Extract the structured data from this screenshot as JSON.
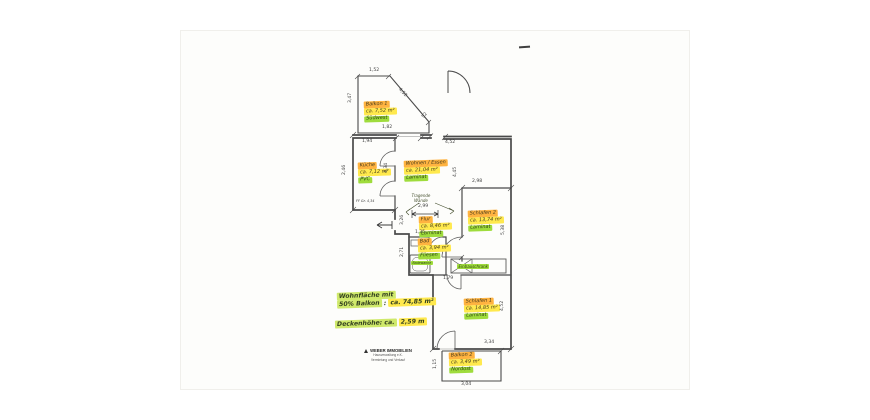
{
  "document": {
    "type": "floor-plan-scan"
  },
  "plan": {
    "rooms": [
      {
        "name": "Balkon 1",
        "area": "ca. 7,52 m²",
        "floor": "Südwest"
      },
      {
        "name": "Küche",
        "area": "ca. 7,12 m²",
        "floor": "PVC"
      },
      {
        "name": "Wohnen / Essen",
        "area": "ca. 21,04 m²",
        "floor": "Laminat"
      },
      {
        "name": "Flur",
        "area": "ca. 8,46 m²",
        "floor": "Laminat"
      },
      {
        "name": "Bad",
        "area": "ca. 3,94 m²",
        "floor": "Fliesen"
      },
      {
        "name": "Schlafen 2",
        "area": "ca. 13,74 m²",
        "floor": "Laminat"
      },
      {
        "name": "Schlafen 1",
        "area": "ca. 14,85 m²",
        "floor": "Laminat"
      },
      {
        "name": "Balkon 2",
        "area": "ca. 3,49 m²",
        "floor": "Nordost"
      }
    ],
    "dimensions": [
      "1,52",
      "3,47",
      "4,52",
      "52",
      "1,82",
      "1,94",
      "4,52",
      "2,46",
      "4,34",
      "4,45",
      "2,98",
      "5,38",
      "2,99",
      "3,26",
      "1,35",
      "2,71",
      "1,79",
      "4,52",
      "3,34",
      "1,15",
      "3,04"
    ],
    "annotations": {
      "tragende_line1": "Tragende",
      "tragende_line2": "Wände",
      "badewanne": "Badewanne",
      "einbauschrank": "Einbauschrank",
      "fenster": "FF Gr. 4,34"
    },
    "notes": {
      "line1": "Wohnfläche mit",
      "line2_label": "50% Balkon",
      "line2_sep": " : ",
      "line2_value": "ca. 74,85 m²",
      "line3_label": "Deckenhöhe: ca.",
      "line3_value": "2,59 m"
    },
    "stamp": {
      "company": "WEBER IMMOBILIEN",
      "line2": "Hausverwaltung e.K.",
      "line3": "Vermietung und Verkauf"
    },
    "colors": {
      "highlight_orange": "#ffb340",
      "highlight_yellow": "#ffe94d",
      "highlight_green": "#9fdc3c",
      "notes_green": "#cfe96b",
      "ink": "#3f3f3f",
      "wall": "#4a4a4a"
    }
  }
}
